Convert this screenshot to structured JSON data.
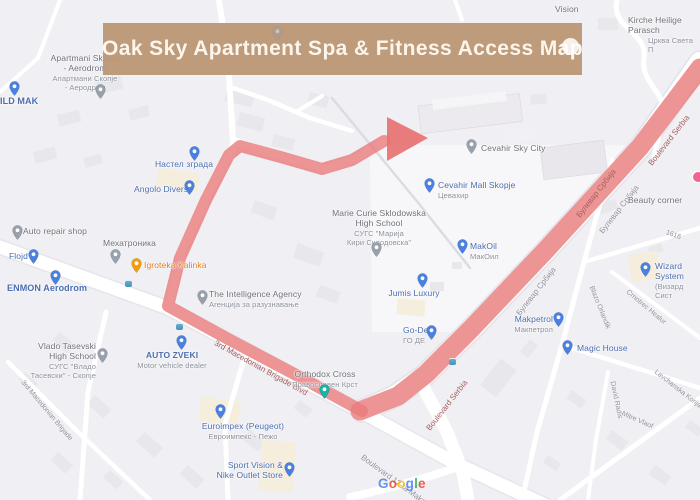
{
  "banner": {
    "title": "Oak Sky Apartment Spa & Fitness Access Map"
  },
  "colors": {
    "banner_bg": "#ba9776",
    "route": "#e87a7a",
    "map_bg": "#f0eff3",
    "poi_blue": "#4a6cb0",
    "poi_gray": "#6e7077",
    "poi_orange": "#e07c1f",
    "street_label": "#8f939d",
    "street_label_on_route": "#a55f5f"
  },
  "pois": [
    {
      "name": "Vision"
    },
    {
      "name": "Kirche Heilige Parasch",
      "sub": "Црква Света П"
    },
    {
      "name": "Apartmani Skopje\n- Aerodrom",
      "sub": "Апартмани Скопје\n- Аеродром"
    },
    {
      "name": "ILD MAK"
    },
    {
      "name": "Настел зграда"
    },
    {
      "name": "Angolo Diverso"
    },
    {
      "name": "Auto repair shop"
    },
    {
      "name": "Flojd"
    },
    {
      "name": "ENMON Aerodrom"
    },
    {
      "name": "Мехатроника"
    },
    {
      "name": "Igroteka Kalinka"
    },
    {
      "name": "The Intelligence Agency",
      "sub": "Агенција за разузнавање"
    },
    {
      "name": "AUTO ZVEKI",
      "sub": "Motor vehicle dealer"
    },
    {
      "name": "Vlado Tasevski\nHigh School",
      "sub": "СУГС \"Владо\nТасевски\" - Скопје"
    },
    {
      "name": "Marie Curie Sklodowska\nHigh School",
      "sub": "СУГС \"Марија\nКири Склодовска\""
    },
    {
      "name": "Cevahir Sky City"
    },
    {
      "name": "Cevahir Mall Skopje",
      "sub": "Цевахир"
    },
    {
      "name": "MakOil",
      "sub": "МакОил"
    },
    {
      "name": "Jumis Luxury"
    },
    {
      "name": "Go-De",
      "sub": "ГО ДЕ"
    },
    {
      "name": "Orthodox Cross",
      "sub": "Православен Крст"
    },
    {
      "name": "Makpetrol",
      "sub": "Макпетрол"
    },
    {
      "name": "Magic House"
    },
    {
      "name": "Wizard System",
      "sub": "(Визард Сист"
    },
    {
      "name": "Beauty corner"
    },
    {
      "name": "Euroimpex (Peugeot)",
      "sub": "Евроимпекс - Пежо"
    },
    {
      "name": "Sport Vision &\nNike Outlet Store"
    }
  ],
  "streets": [
    {
      "label": "3rd Macedonian Brigade Blvd"
    },
    {
      "label": "Boulevard Serbia"
    },
    {
      "label": "Булевар Србија"
    },
    {
      "label": "Булевар Србија"
    },
    {
      "label": "Булевар Србија"
    },
    {
      "label": "Boulevard Serbia"
    },
    {
      "label": "Boulevard 12-ta Makedonska"
    },
    {
      "label": "3rd Macedonian Brigade"
    },
    {
      "label": "1616"
    },
    {
      "label": "Blazo Orlandik"
    },
    {
      "label": "Lavchanska Korija"
    },
    {
      "label": "David Radis"
    },
    {
      "label": "Mitre Vlaof"
    },
    {
      "label": "Crnotrec Healur"
    }
  ],
  "attribution": {
    "letters": [
      "G",
      "o",
      "o",
      "g",
      "l",
      "e"
    ]
  }
}
